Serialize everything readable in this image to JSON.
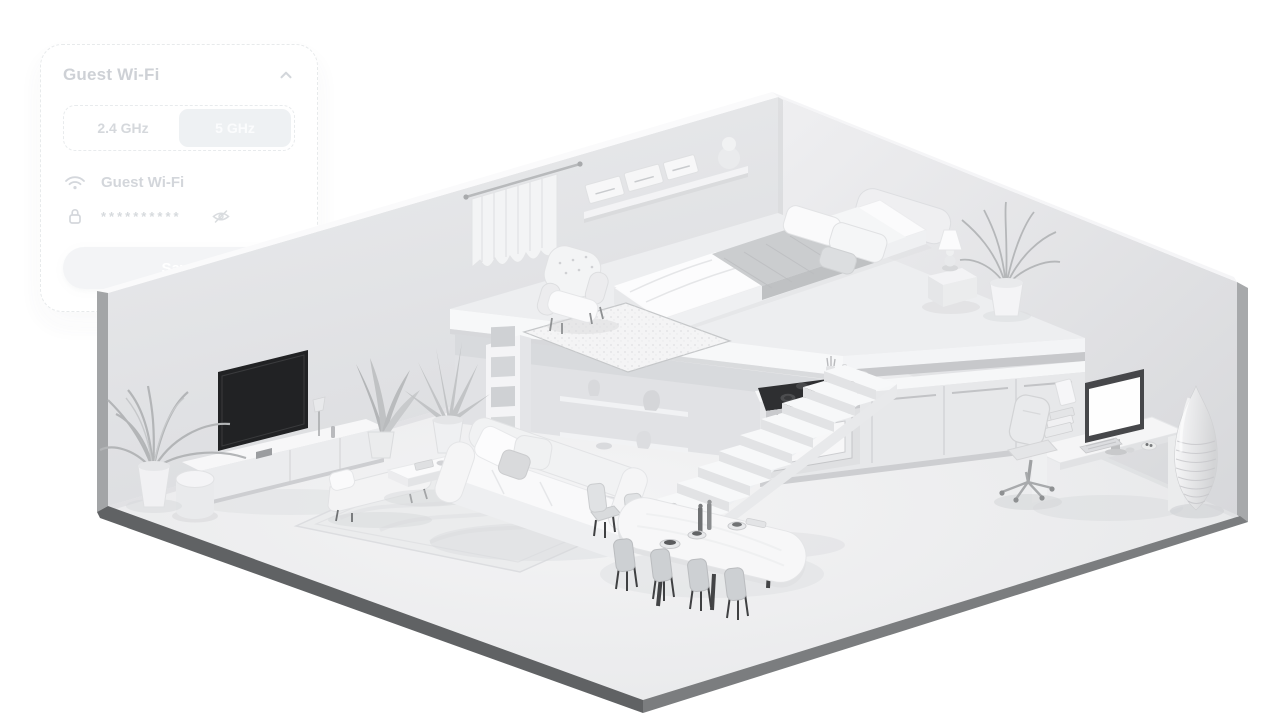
{
  "wifi_card": {
    "title": "Guest Wi-Fi",
    "collapse_icon": "chevron-up-icon",
    "bands": [
      {
        "label": "2.4 GHz",
        "selected": false
      },
      {
        "label": "5 GHz",
        "selected": true
      }
    ],
    "network": {
      "icon": "wifi-icon",
      "ssid": "Guest Wi-Fi"
    },
    "password": {
      "icon": "lock-icon",
      "masked_value": "**********",
      "visibility_icon": "eye-off-icon"
    },
    "save_label": "Save"
  },
  "scene": {
    "type": "isometric-3d-apartment-render",
    "style": "monochrome white and gray cutaway, two back walls and floor slab",
    "levels": [
      {
        "name": "mezzanine-bedroom",
        "objects": [
          "curtained-window",
          "wall-shelf-with-boxes",
          "sphere-decor",
          "double-bed",
          "pillows",
          "gray-blanket",
          "headboard",
          "tufted-armchair",
          "fluffy-rug",
          "nightstand",
          "table-lamp",
          "potted-palm"
        ]
      },
      {
        "name": "ground-floor",
        "objects": [
          "tv",
          "tv-console",
          "floor-lamp",
          "pouf",
          "potted-palm-left",
          "potted-plant-mid",
          "potted-plant-tall",
          "bookshelf-cubbies",
          "display-shelves-vases",
          "sofa-with-cushions",
          "daybed-bench",
          "coffee-table",
          "area-rug",
          "staircase",
          "kitchen-counter",
          "stove-with-oven",
          "dining-table",
          "dining-chairs-x8",
          "office-desk",
          "monitor",
          "keyboard",
          "office-chair",
          "desk-books",
          "tall-ribbed-floor-vase"
        ]
      }
    ],
    "colors": {
      "background": "#ffffff",
      "wall_left": "#e2e3e6",
      "wall_right": "#e6e7ea",
      "floor": "#eff0f1",
      "slab_edge_dark": "#636567",
      "outer_wall_strip": "#a5a7a9",
      "tv_screen": "#212224",
      "stove_top": "#2e2f31",
      "chair_leg_dark": "#3f4042",
      "blanket_gray": "#cbcdcf"
    }
  }
}
